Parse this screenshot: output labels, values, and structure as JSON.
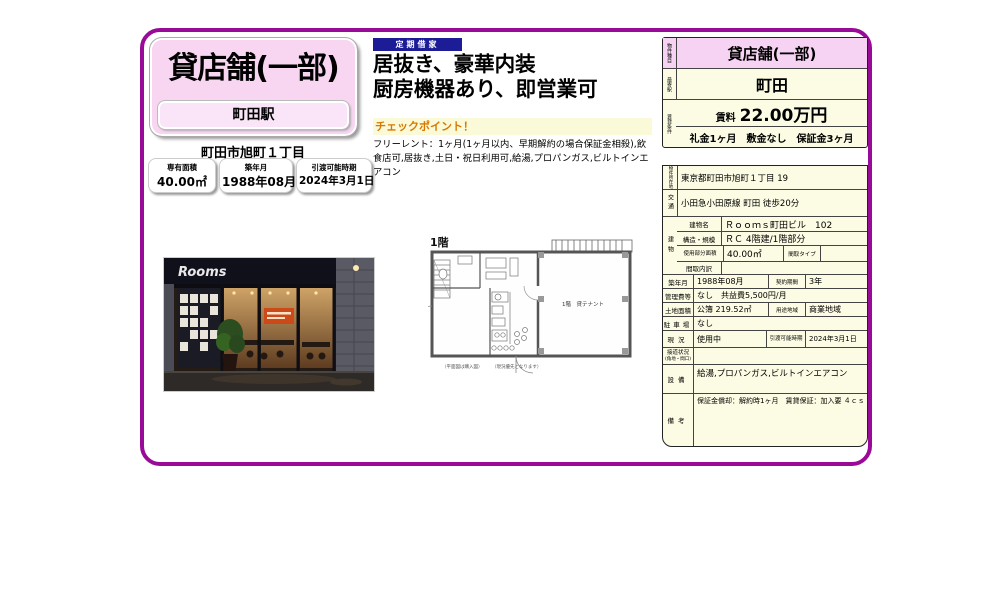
{
  "accent_colors": {
    "frame_purple": "#990a99",
    "pink": "#f8d6f2",
    "cream": "#fcfce4",
    "navy_badge": "#1c1c96",
    "checkpoint_orange": "#d97800"
  },
  "left_card": {
    "property_type": "貸店舗(一部)",
    "station": "町田駅",
    "address": "町田市旭町１丁目",
    "badges": [
      {
        "label": "専有面積",
        "value": "40.00㎡"
      },
      {
        "label": "築年月",
        "value": "1988年08月"
      },
      {
        "label": "引渡可能時期",
        "value": "2024年3月1日"
      }
    ]
  },
  "promo": {
    "lease_type_badge": "定期借家",
    "headline_line1": "居抜き、豪華内装",
    "headline_line2": "厨房機器あり、即営業可",
    "checkpoint_title": "チェックポイント！",
    "checkpoint_body": "フリーレント：1ヶ月(1ヶ月以内、早期解約の場合保証金相殺),飲食店可,居抜き,土日・祝日利用可,給湯,プロパンガス,ビルトインエアコン"
  },
  "photo": {
    "sign_text": "Rooms"
  },
  "floorplan": {
    "floor_label": "1階",
    "room_label": "1階　貸テナント",
    "note1": "（平面図は購入図）",
    "note2": "（現況優先となります）"
  },
  "summary_table": {
    "type_label": "物件種目",
    "type_value": "貸店舗(一部)",
    "station_label": "最寄駅",
    "station_value": "町田",
    "terms_label": "賃貸条件",
    "rent_label": "賃料",
    "rent_value": "22.00万円",
    "fees_line": "礼金1ヶ月　敷金なし　保証金3ヶ月"
  },
  "detail": {
    "address": {
      "label": "物件所在地",
      "value": "東京都町田市旭町１丁目 19"
    },
    "access": {
      "label": "交通",
      "value": "小田急小田原線 町田 徒歩20分"
    },
    "building": {
      "label": "建物",
      "name_label": "建物名",
      "name_value": "Ｒｏｏｍｓ町田ビル　102",
      "structure_label": "構造・規模",
      "structure_value": "ＲＣ 4階建/1階部分",
      "area_label": "使用部分面積",
      "area_value": "40.00㎡",
      "madori_type_label": "間取タイプ",
      "madori_type_value": "",
      "madori_label": "間取内訳",
      "madori_value": ""
    },
    "built": {
      "label": "築年月",
      "value": "1988年08月"
    },
    "contract": {
      "label": "契約期間",
      "value": "3年"
    },
    "mgmt": {
      "label": "管理費等",
      "value": "なし　共益費5,500円/月"
    },
    "land": {
      "label": "土地面積",
      "value": "公簿 219.52㎡"
    },
    "zoning": {
      "label": "用途地域",
      "value": "商業地域"
    },
    "parking": {
      "label": "駐車場",
      "value": "なし"
    },
    "status": {
      "label": "現況",
      "value": "使用中"
    },
    "handover": {
      "label": "引渡可能時期",
      "value": "2024年3月1日"
    },
    "road": {
      "label": "接道状況",
      "label_sub": "(角地・間口)",
      "value": ""
    },
    "equipment": {
      "label": "設備",
      "value": "給湯,プロパンガス,ビルトインエアコン"
    },
    "remarks": {
      "label": "備考",
      "value": "保証金償却：解約時1ヶ月　賃貸保証：加入要 ４ｃｓ"
    }
  }
}
